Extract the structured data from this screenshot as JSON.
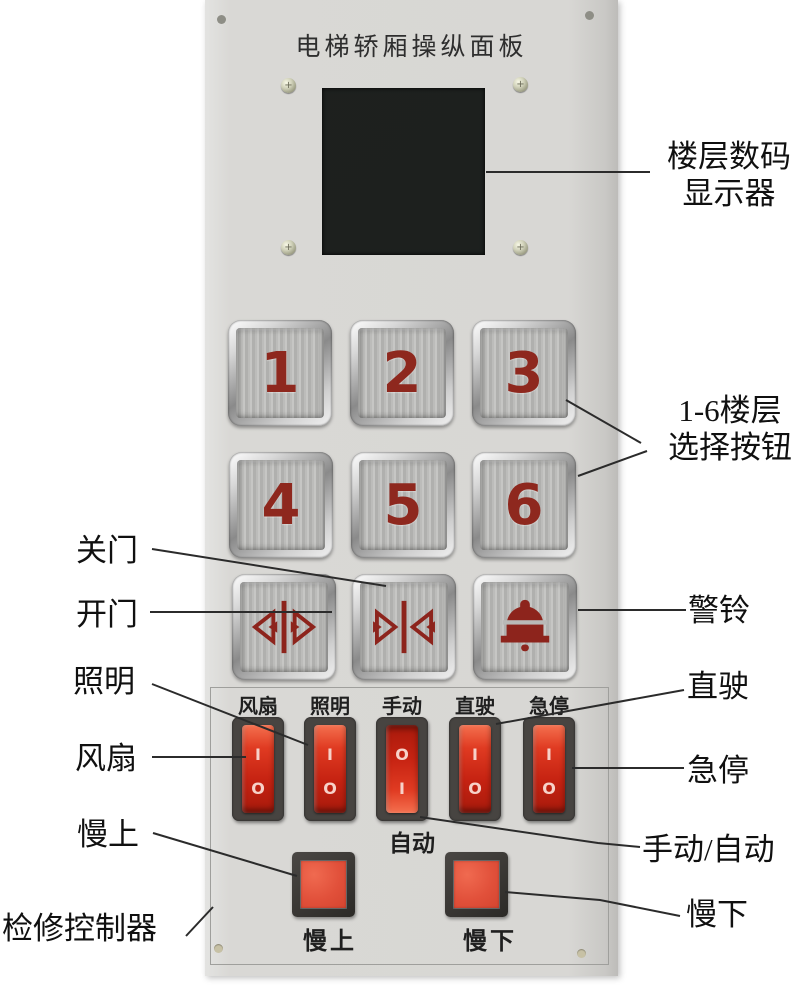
{
  "title": "电梯轿厢操纵面板",
  "floors": [
    "1",
    "2",
    "3",
    "4",
    "5",
    "6"
  ],
  "switches": [
    {
      "label": "风扇",
      "top": "I",
      "bottom": "O"
    },
    {
      "label": "照明",
      "top": "I",
      "bottom": "O"
    },
    {
      "label": "手动",
      "top": "O",
      "bottom": "I"
    },
    {
      "label": "直驶",
      "top": "I",
      "bottom": "O"
    },
    {
      "label": "急停",
      "top": "I",
      "bottom": "O"
    }
  ],
  "printed": {
    "auto": "自动",
    "slow_up": "慢上",
    "slow_down": "慢下"
  },
  "icons": {
    "door_open": "door-open-arrows",
    "door_close": "door-close-arrows",
    "alarm": "bell"
  },
  "callouts": {
    "display": [
      "楼层数码",
      "显示器"
    ],
    "floor_select": [
      "1-6楼层",
      "选择按钮"
    ],
    "close_door": "关门",
    "open_door": "开门",
    "bell": "警铃",
    "lighting": "照明",
    "direct_drive": "直驶",
    "fan": "风扇",
    "emergency_stop": "急停",
    "slow_up": "慢上",
    "manual_auto": "手动/自动",
    "inspection_controller": "检修控制器",
    "slow_down": "慢下"
  },
  "colors": {
    "panel": "#d8d7d4",
    "button_red": "#8e281e",
    "rocker_red": "#c62312",
    "display_black": "#1d201e"
  }
}
